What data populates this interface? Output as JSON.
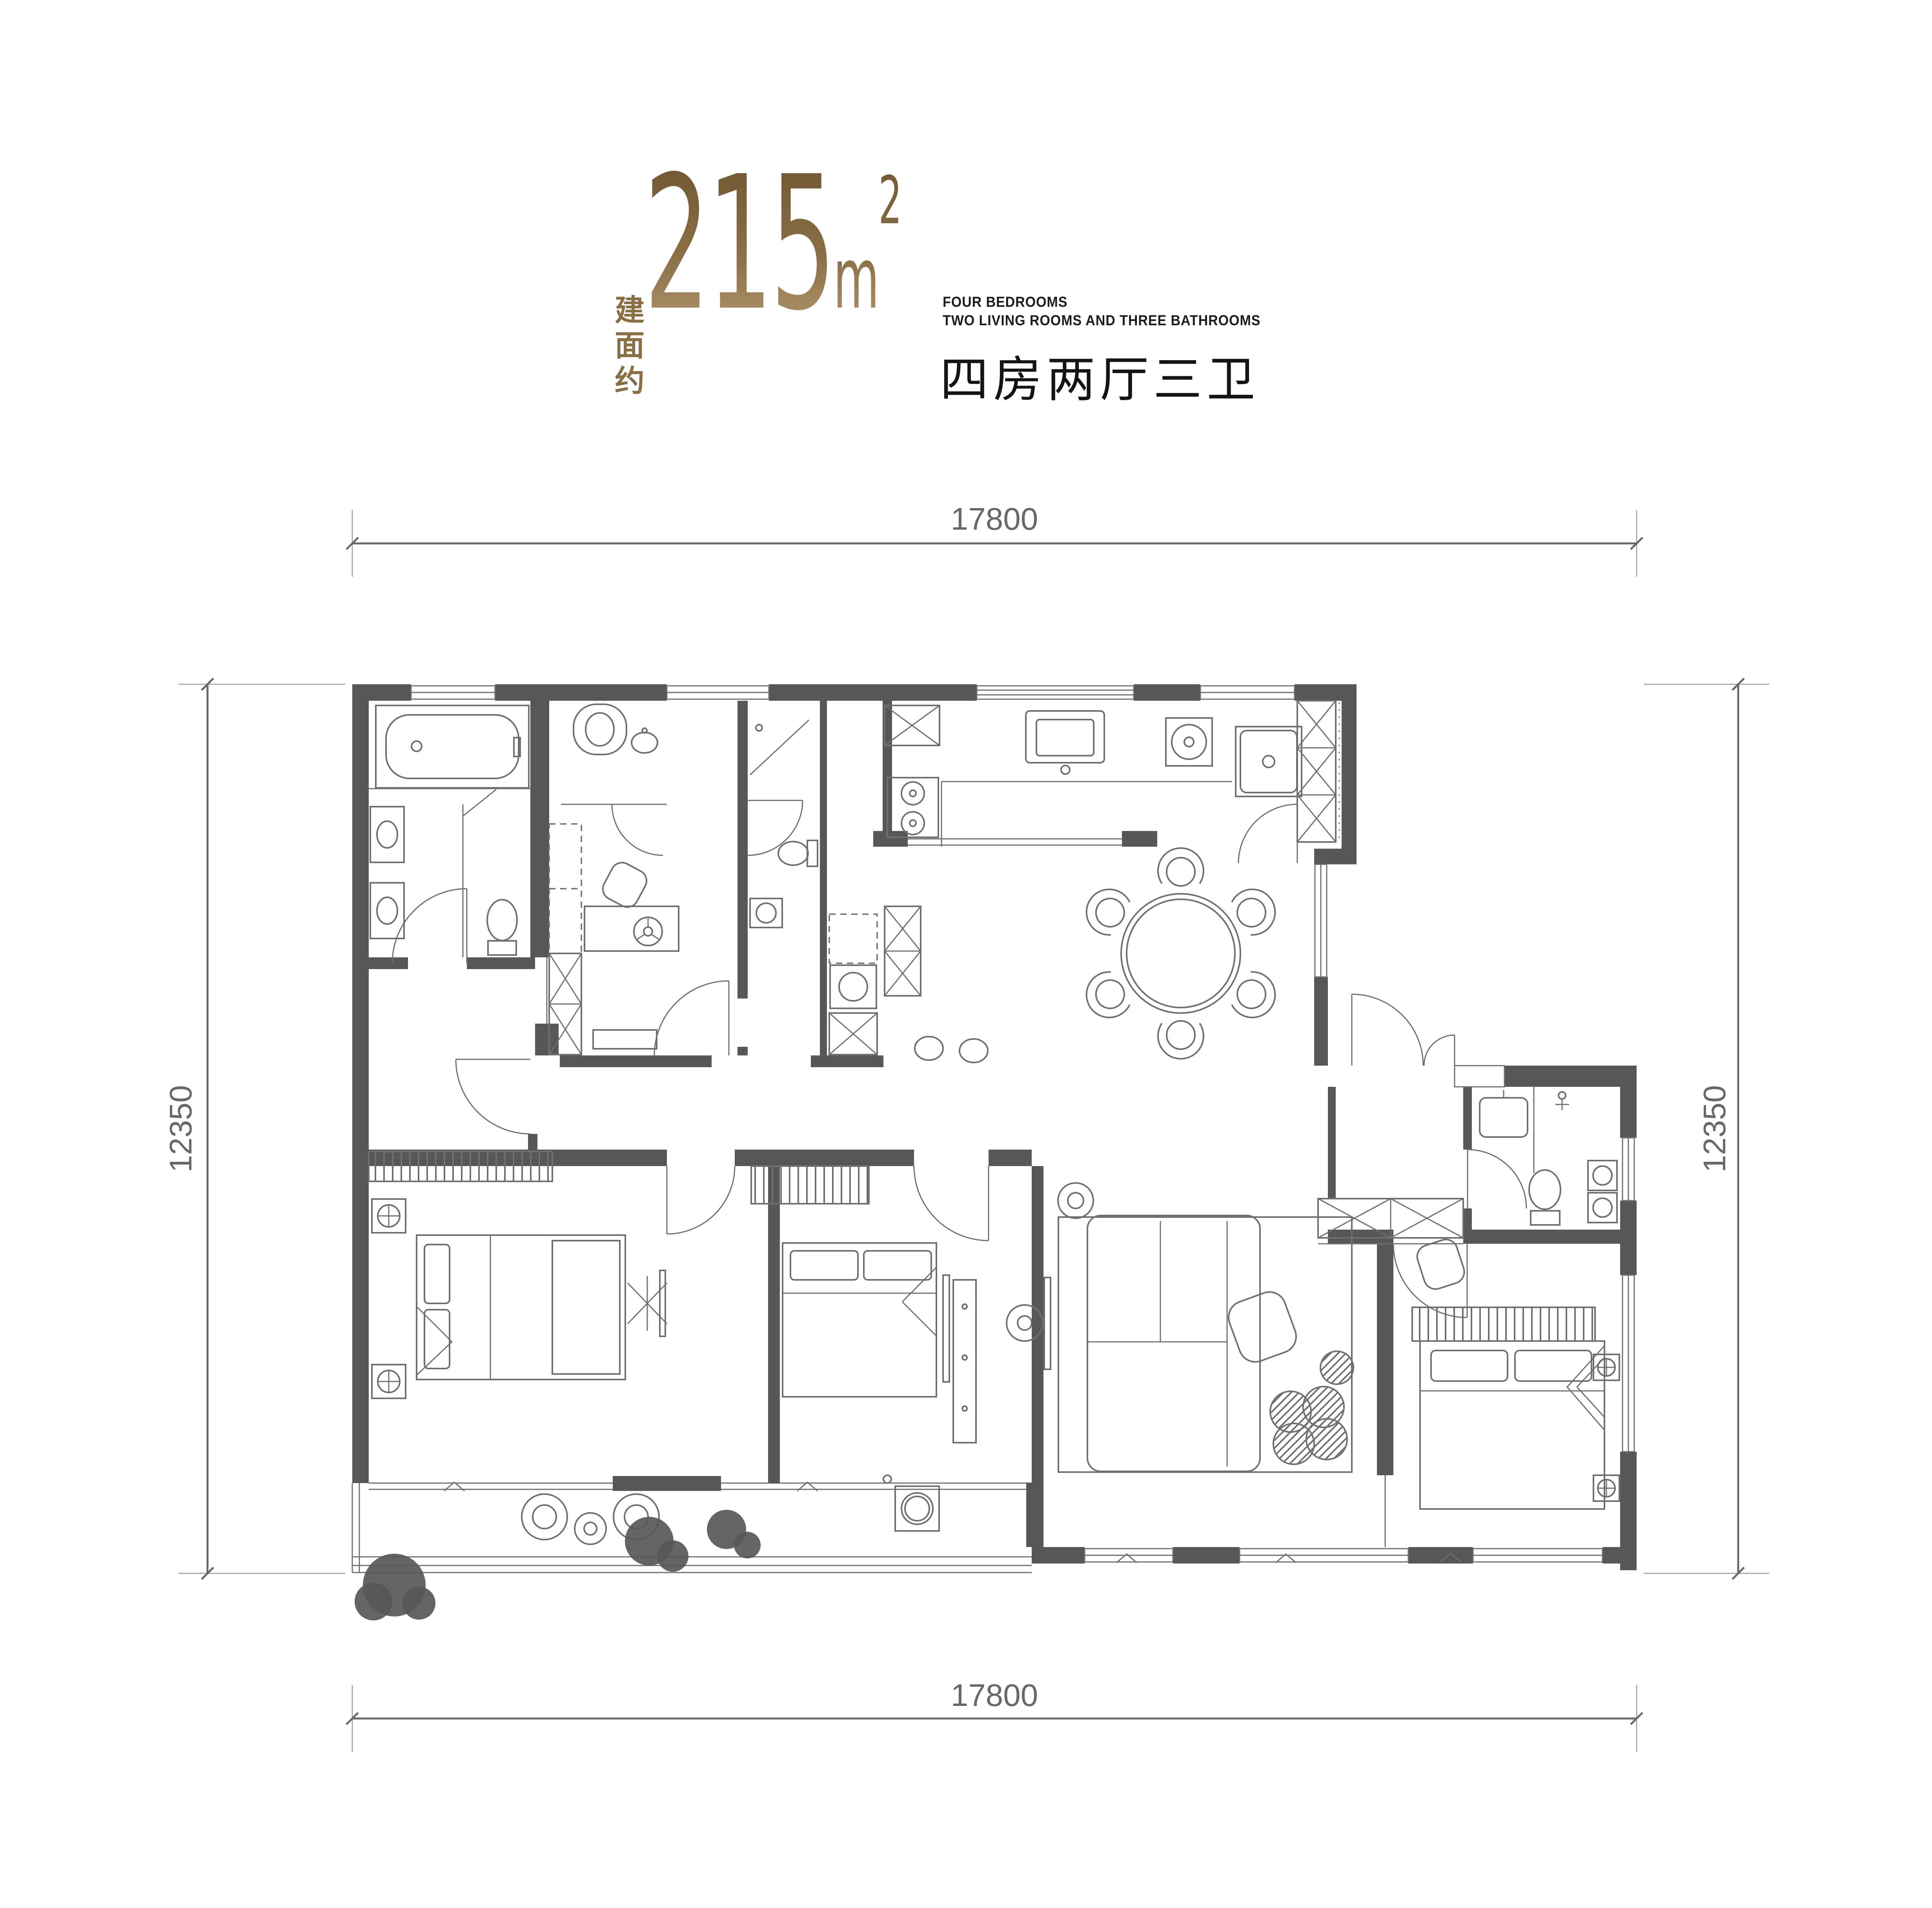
{
  "title": {
    "prefix_cn": "建面约",
    "area_int": "215",
    "area_unit": "m",
    "area_sup": "2",
    "tagline_en_1": "FOUR BEDROOMS",
    "tagline_en_2": "TWO LIVING ROOMS AND THREE BATHROOMS",
    "tagline_cn": "四房两厅三卫"
  },
  "dimensions": {
    "top": "17800",
    "bottom": "17800",
    "left": "12350",
    "right": "12350"
  },
  "colors": {
    "gold-dark": "#6d5530",
    "gold-mid": "#8a6f45",
    "gold-light": "#b29871",
    "wall": "#575757",
    "line": "#6f6f6f",
    "dim": "#686868",
    "ink": "#1c1c1c"
  }
}
